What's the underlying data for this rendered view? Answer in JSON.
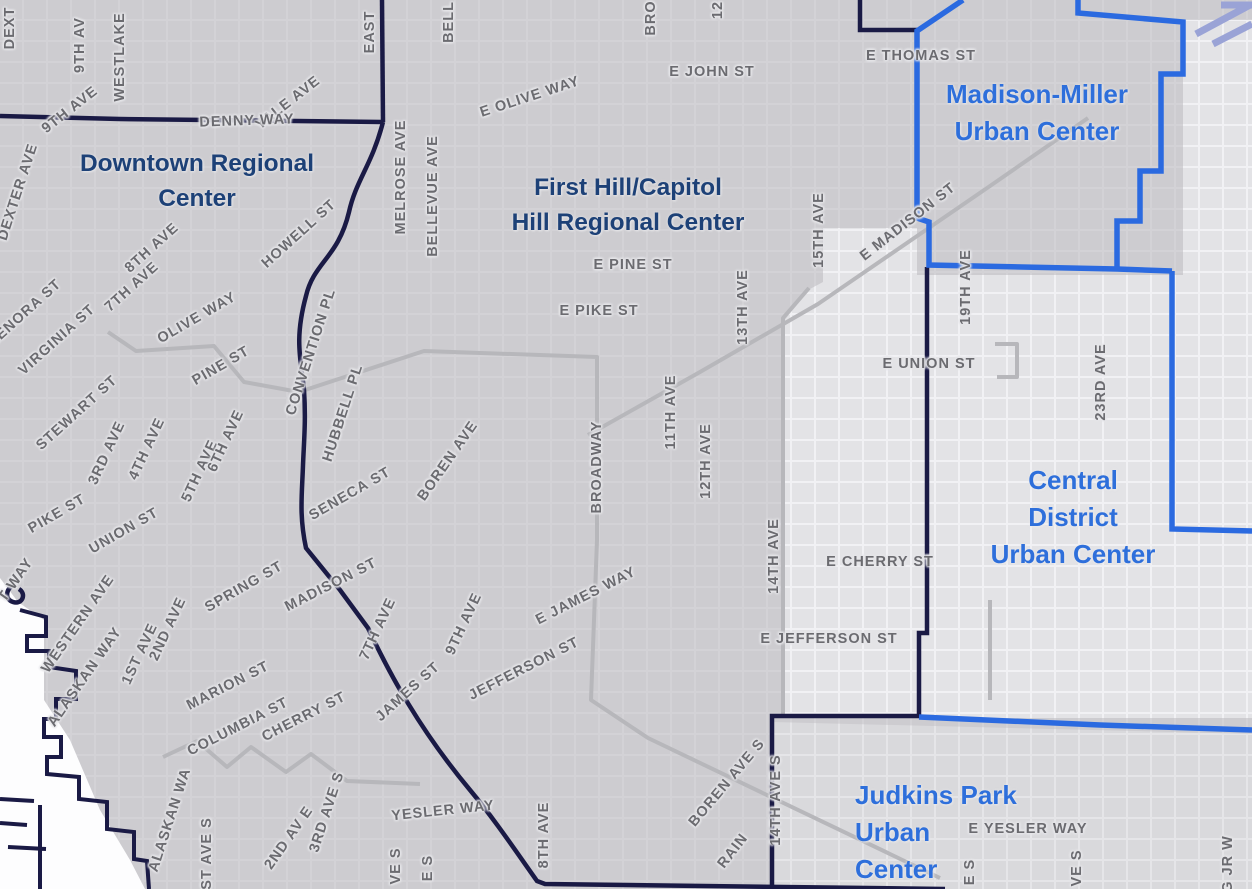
{
  "map": {
    "title": "Seattle Regional and Urban Centers map excerpt",
    "colors": {
      "background": "#cdccd0",
      "light_area": "#e3e3e6",
      "white_street_grid": "#f4f4f6",
      "arterial_street_gray": "#b7b7bb",
      "regional_center_boundary_navy": "#1a1a45",
      "urban_center_boundary_blue": "#2b6ae0",
      "regional_center_label_navy": "#1d4177",
      "urban_center_label_blue": "#2e6fdb",
      "street_label_gray": "#6b6b70",
      "water_white": "#fdfdfe",
      "highway_periwinkle": "#9aa3d6"
    },
    "legend_semantics": {
      "navy_line": "Regional Center boundary",
      "blue_line": "Urban Center boundary",
      "gray_line": "Arterial street",
      "white_area": "Water (Elliott Bay waterfront with piers)"
    },
    "centers": [
      {
        "id": "downtown",
        "type": "regional",
        "lines": [
          "Downtown Regional",
          "Center"
        ],
        "x": 197,
        "y": 146,
        "align": "center"
      },
      {
        "id": "first-hill-capitol-hill",
        "type": "regional",
        "lines": [
          "First Hill/Capitol",
          "Hill Regional Center"
        ],
        "x": 628,
        "y": 170,
        "align": "center"
      },
      {
        "id": "madison-miller",
        "type": "urban",
        "lines": [
          "Madison-Miller",
          "Urban Center"
        ],
        "x": 1037,
        "y": 76,
        "align": "center"
      },
      {
        "id": "central-district",
        "type": "urban",
        "lines": [
          "Central",
          "District",
          "Urban Center"
        ],
        "x": 1073,
        "y": 462,
        "align": "center"
      },
      {
        "id": "judkins-park",
        "type": "urban",
        "lines": [
          "Judkins Park",
          "Urban",
          "Center"
        ],
        "x": 855,
        "y": 777,
        "align": "left"
      }
    ],
    "street_label_format": [
      "text",
      "x_center",
      "y_center",
      "rotation_deg"
    ],
    "street_labels": [
      [
        "DEXT",
        10,
        28,
        -90
      ],
      [
        "9TH AV",
        80,
        45,
        -90
      ],
      [
        "WESTLAKE",
        120,
        57,
        -90
      ],
      [
        "9TH AVE",
        70,
        110,
        -38
      ],
      [
        "DEXTER AVE",
        18,
        192,
        -72
      ],
      [
        "YALE AVE",
        288,
        103,
        -38
      ],
      [
        "DENNY WAY",
        247,
        121,
        -2
      ],
      [
        "EAST",
        370,
        32,
        -90
      ],
      [
        "MELROSE AVE",
        401,
        177,
        -90
      ],
      [
        "BELLEVUE AVE",
        433,
        196,
        -90
      ],
      [
        "BELL",
        449,
        22,
        -90
      ],
      [
        "E OLIVE WAY",
        530,
        97,
        -18
      ],
      [
        "BRO",
        651,
        18,
        -90
      ],
      [
        "E JOHN ST",
        712,
        72,
        0
      ],
      [
        "12",
        718,
        10,
        -90
      ],
      [
        "E THOMAS ST",
        921,
        56,
        0
      ],
      [
        "E MADISON ST",
        908,
        222,
        -38
      ],
      [
        "19TH AVE",
        966,
        287,
        -90
      ],
      [
        "15TH AVE",
        819,
        230,
        -90
      ],
      [
        "13TH AVE",
        743,
        307,
        -90
      ],
      [
        "E PINE ST",
        633,
        265,
        0
      ],
      [
        "E PIKE ST",
        599,
        311,
        0
      ],
      [
        "E UNION ST",
        929,
        364,
        0
      ],
      [
        "23RD AVE",
        1101,
        382,
        -90
      ],
      [
        "8TH AVE",
        152,
        248,
        -42
      ],
      [
        "7TH AVE",
        132,
        287,
        -42
      ],
      [
        "HOWELL ST",
        299,
        234,
        -42
      ],
      [
        "OLIVE WAY",
        197,
        318,
        -30
      ],
      [
        "PINE ST",
        221,
        366,
        -30
      ],
      [
        "LENORA ST",
        25,
        313,
        -42
      ],
      [
        "VIRGINIA ST",
        57,
        340,
        -42
      ],
      [
        "STEWART ST",
        77,
        413,
        -42
      ],
      [
        "CONVENTION PL",
        311,
        352,
        -72
      ],
      [
        "HUBBELL PL",
        343,
        413,
        -72
      ],
      [
        "3RD AVE",
        107,
        453,
        -65
      ],
      [
        "4TH AVE",
        147,
        449,
        -65
      ],
      [
        "5TH AVE",
        200,
        471,
        -65
      ],
      [
        "6TH AVE",
        226,
        441,
        -65
      ],
      [
        "PIKE ST",
        57,
        514,
        -30
      ],
      [
        "UNION ST",
        124,
        531,
        -30
      ],
      [
        "SENECA ST",
        350,
        494,
        -30
      ],
      [
        "BOREN AVE",
        448,
        461,
        -55
      ],
      [
        "MADISON ST",
        331,
        585,
        -27
      ],
      [
        "SPRING ST",
        244,
        587,
        -30
      ],
      [
        "BROADWAY",
        597,
        467,
        -90
      ],
      [
        "11TH AVE",
        671,
        412,
        -90
      ],
      [
        "12TH AVE",
        706,
        461,
        -90
      ],
      [
        "14TH AVE",
        774,
        556,
        -90
      ],
      [
        "T WAY",
        16,
        580,
        -55
      ],
      [
        "WESTERN AVE",
        78,
        624,
        -55
      ],
      [
        "ALASKAN WAY",
        85,
        677,
        -55
      ],
      [
        "2ND AVE",
        168,
        629,
        -65
      ],
      [
        "1ST AVE",
        140,
        654,
        -65
      ],
      [
        "MARION ST",
        228,
        686,
        -27
      ],
      [
        "COLUMBIA ST",
        238,
        727,
        -27
      ],
      [
        "CHERRY ST",
        304,
        717,
        -27
      ],
      [
        "7TH AVE",
        378,
        629,
        -65
      ],
      [
        "9TH AVE",
        464,
        624,
        -65
      ],
      [
        "JAMES ST",
        408,
        692,
        -42
      ],
      [
        "E JAMES WAY",
        586,
        596,
        -27
      ],
      [
        "JEFFERSON ST",
        524,
        669,
        -27
      ],
      [
        "E JEFFERSON ST",
        829,
        639,
        0
      ],
      [
        "E CHERRY ST",
        880,
        562,
        0
      ],
      [
        "ALASKAN WA",
        170,
        820,
        -72
      ],
      [
        "1ST AVE S",
        207,
        858,
        -90
      ],
      [
        "2ND AV E",
        289,
        838,
        -55
      ],
      [
        "3RD AVE S",
        327,
        812,
        -72
      ],
      [
        "YESLER WAY",
        443,
        811,
        -6
      ],
      [
        "8TH AVE",
        544,
        835,
        -90
      ],
      [
        "VE S",
        396,
        866,
        -90
      ],
      [
        "E S",
        428,
        868,
        -90
      ],
      [
        "BOREN AVE S",
        727,
        783,
        -50
      ],
      [
        "RAIN",
        733,
        851,
        -52
      ],
      [
        "14TH AVE S",
        776,
        800,
        -90
      ],
      [
        "E YESLER WAY",
        1028,
        829,
        0
      ],
      [
        "E S",
        970,
        872,
        -90
      ],
      [
        "VE S",
        1077,
        868,
        -90
      ],
      [
        "G JR W",
        1228,
        864,
        -90
      ]
    ]
  }
}
